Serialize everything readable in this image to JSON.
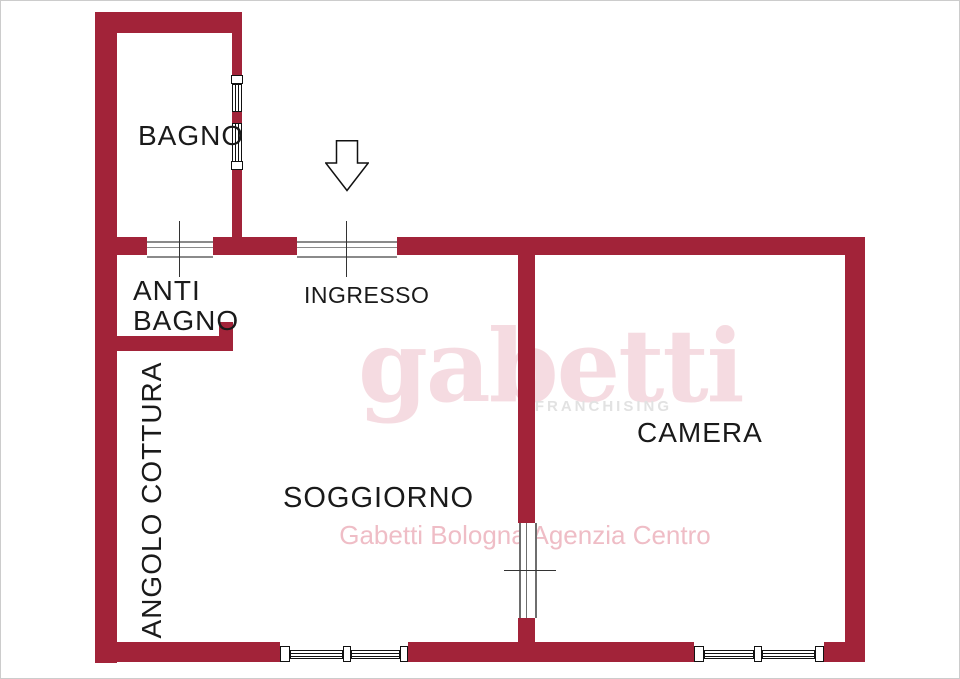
{
  "plan": {
    "rooms": {
      "bagno": "BAGNO",
      "anti_bagno": {
        "line1": "ANTI",
        "line2": "BAGNO"
      },
      "ingresso": "INGRESSO",
      "angolo_cottura": "ANGOLO COTTURA",
      "soggiorno": "SOGGIORNO",
      "camera": "CAMERA"
    },
    "entrance_arrow": "down-arrow"
  },
  "watermark": {
    "brand": "gabetti",
    "brand_sub": "FRANCHISING",
    "agency": "Gabetti Bologna Agenzia Centro"
  },
  "colors": {
    "wall": "#A22339",
    "label": "#1A1A1A",
    "opening_line": "#8A8A8A",
    "window_line": "#111111",
    "brand_pink": "#F5D8DE",
    "franchising_gray": "#E2E2E2",
    "agency_pink": "#EFBDC6"
  }
}
